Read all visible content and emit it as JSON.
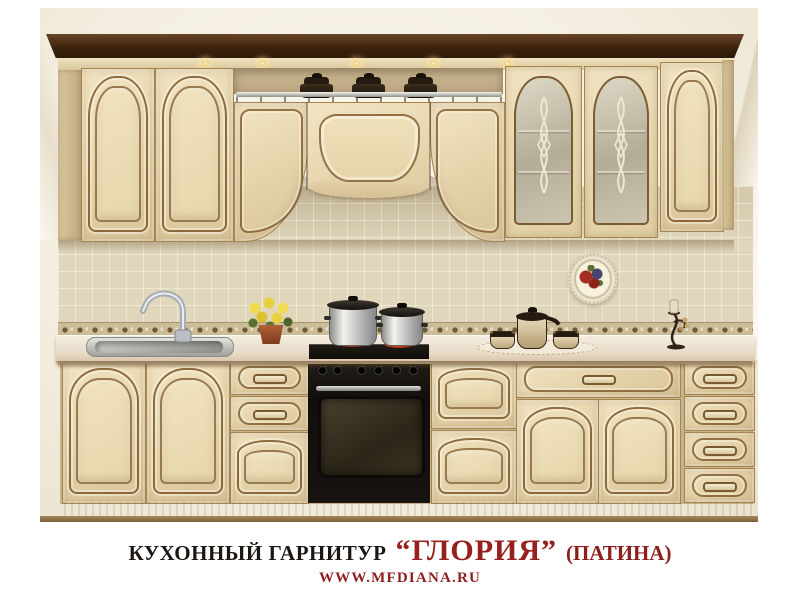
{
  "caption": {
    "prefix": "КУХОННЫЙ ГАРНИТУР",
    "product_name": "“ГЛОРИЯ”",
    "finish_note": "(ПАТИНА)",
    "website": "WWW.MFDIANA.RU"
  },
  "palette": {
    "caption_text": "#1c1713",
    "caption_accent": "#8e1e1c",
    "cabinet_cream": "#ecdcba",
    "patina_outline": "#8a6038",
    "crown_molding": "#3c230e",
    "wall": "#f6f2e6",
    "tile": "#e0d6bb",
    "countertop": "#eee3d2",
    "appliance_black": "#17130f",
    "steel": "#c9cdd0",
    "flower_yellow": "#e8d242",
    "terracotta_pot": "#9c4f2e"
  }
}
